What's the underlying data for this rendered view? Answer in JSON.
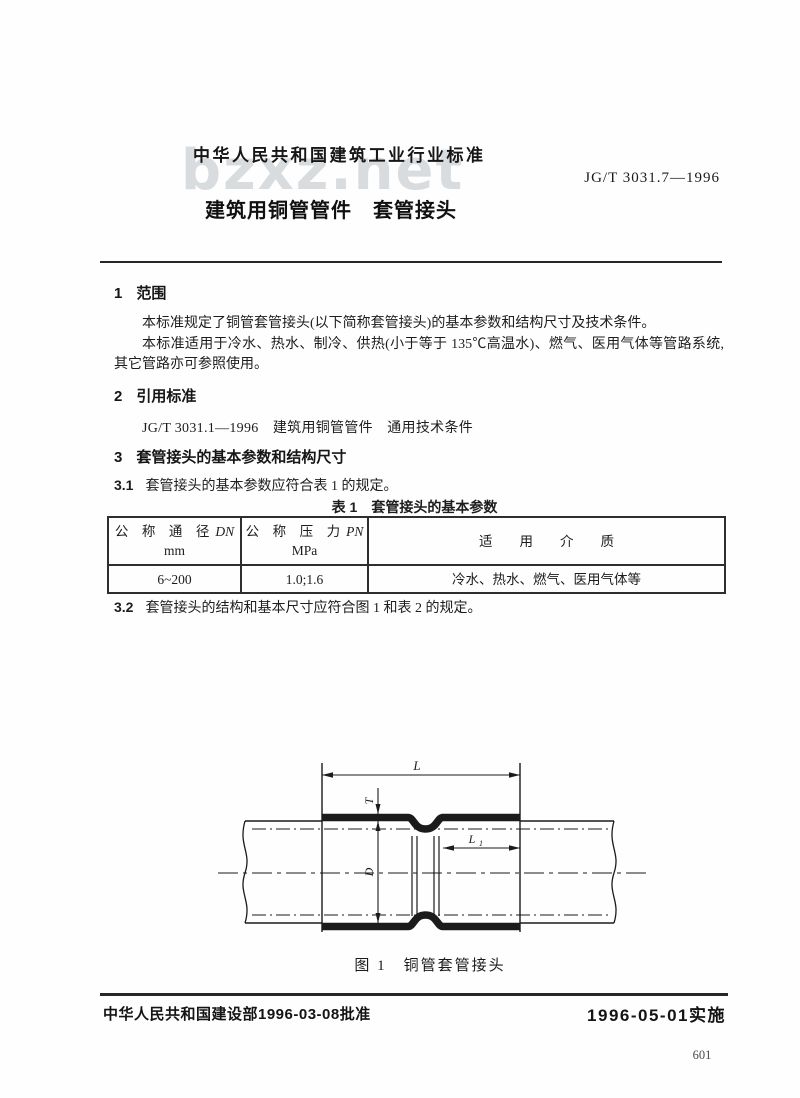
{
  "watermark": "bzxz.net",
  "header": {
    "standard_class": "中华人民共和国建筑工业行业标准",
    "standard_number": "JG/T 3031.7—1996",
    "doc_title": "建筑用铜管管件　套管接头"
  },
  "sections": {
    "s1_num": "1",
    "s1_title": "范围",
    "s1_p1": "本标准规定了铜管套管接头(以下简称套管接头)的基本参数和结构尺寸及技术条件。",
    "s1_p2": "本标准适用于冷水、热水、制冷、供热(小于等于 135℃高温水)、燃气、医用气体等管路系统,其它管路亦可参照使用。",
    "s2_num": "2",
    "s2_title": "引用标准",
    "s2_ref": "JG/T 3031.1—1996　建筑用铜管管件　通用技术条件",
    "s3_num": "3",
    "s3_title": "套管接头的基本参数和结构尺寸",
    "c31_num": "3.1",
    "c31_text": "套管接头的基本参数应符合表 1 的规定。",
    "c32_num": "3.2",
    "c32_text": "套管接头的结构和基本尺寸应符合图 1 和表 2 的规定。"
  },
  "table1": {
    "title": "表 1　套管接头的基本参数",
    "col1_zh": "公　称　通　径",
    "col1_sym": "DN",
    "col1_unit": "mm",
    "col2_zh": "公　称　压　力",
    "col2_sym": "PN",
    "col2_unit": "MPa",
    "col3_zh": "适　　用　　介　　质",
    "row_dn": "6~200",
    "row_pn": "1.0;1.6",
    "row_media": "冷水、热水、燃气、医用气体等"
  },
  "figure": {
    "caption": "图 1　铜管套管接头",
    "label_L": "L",
    "label_T": "T",
    "label_D": "D",
    "label_L1_main": "L",
    "label_L1_sub": "1"
  },
  "footer": {
    "approved": "中华人民共和国建设部1996-03-08批准",
    "implemented": "1996-05-01实施",
    "page_number": "601"
  }
}
